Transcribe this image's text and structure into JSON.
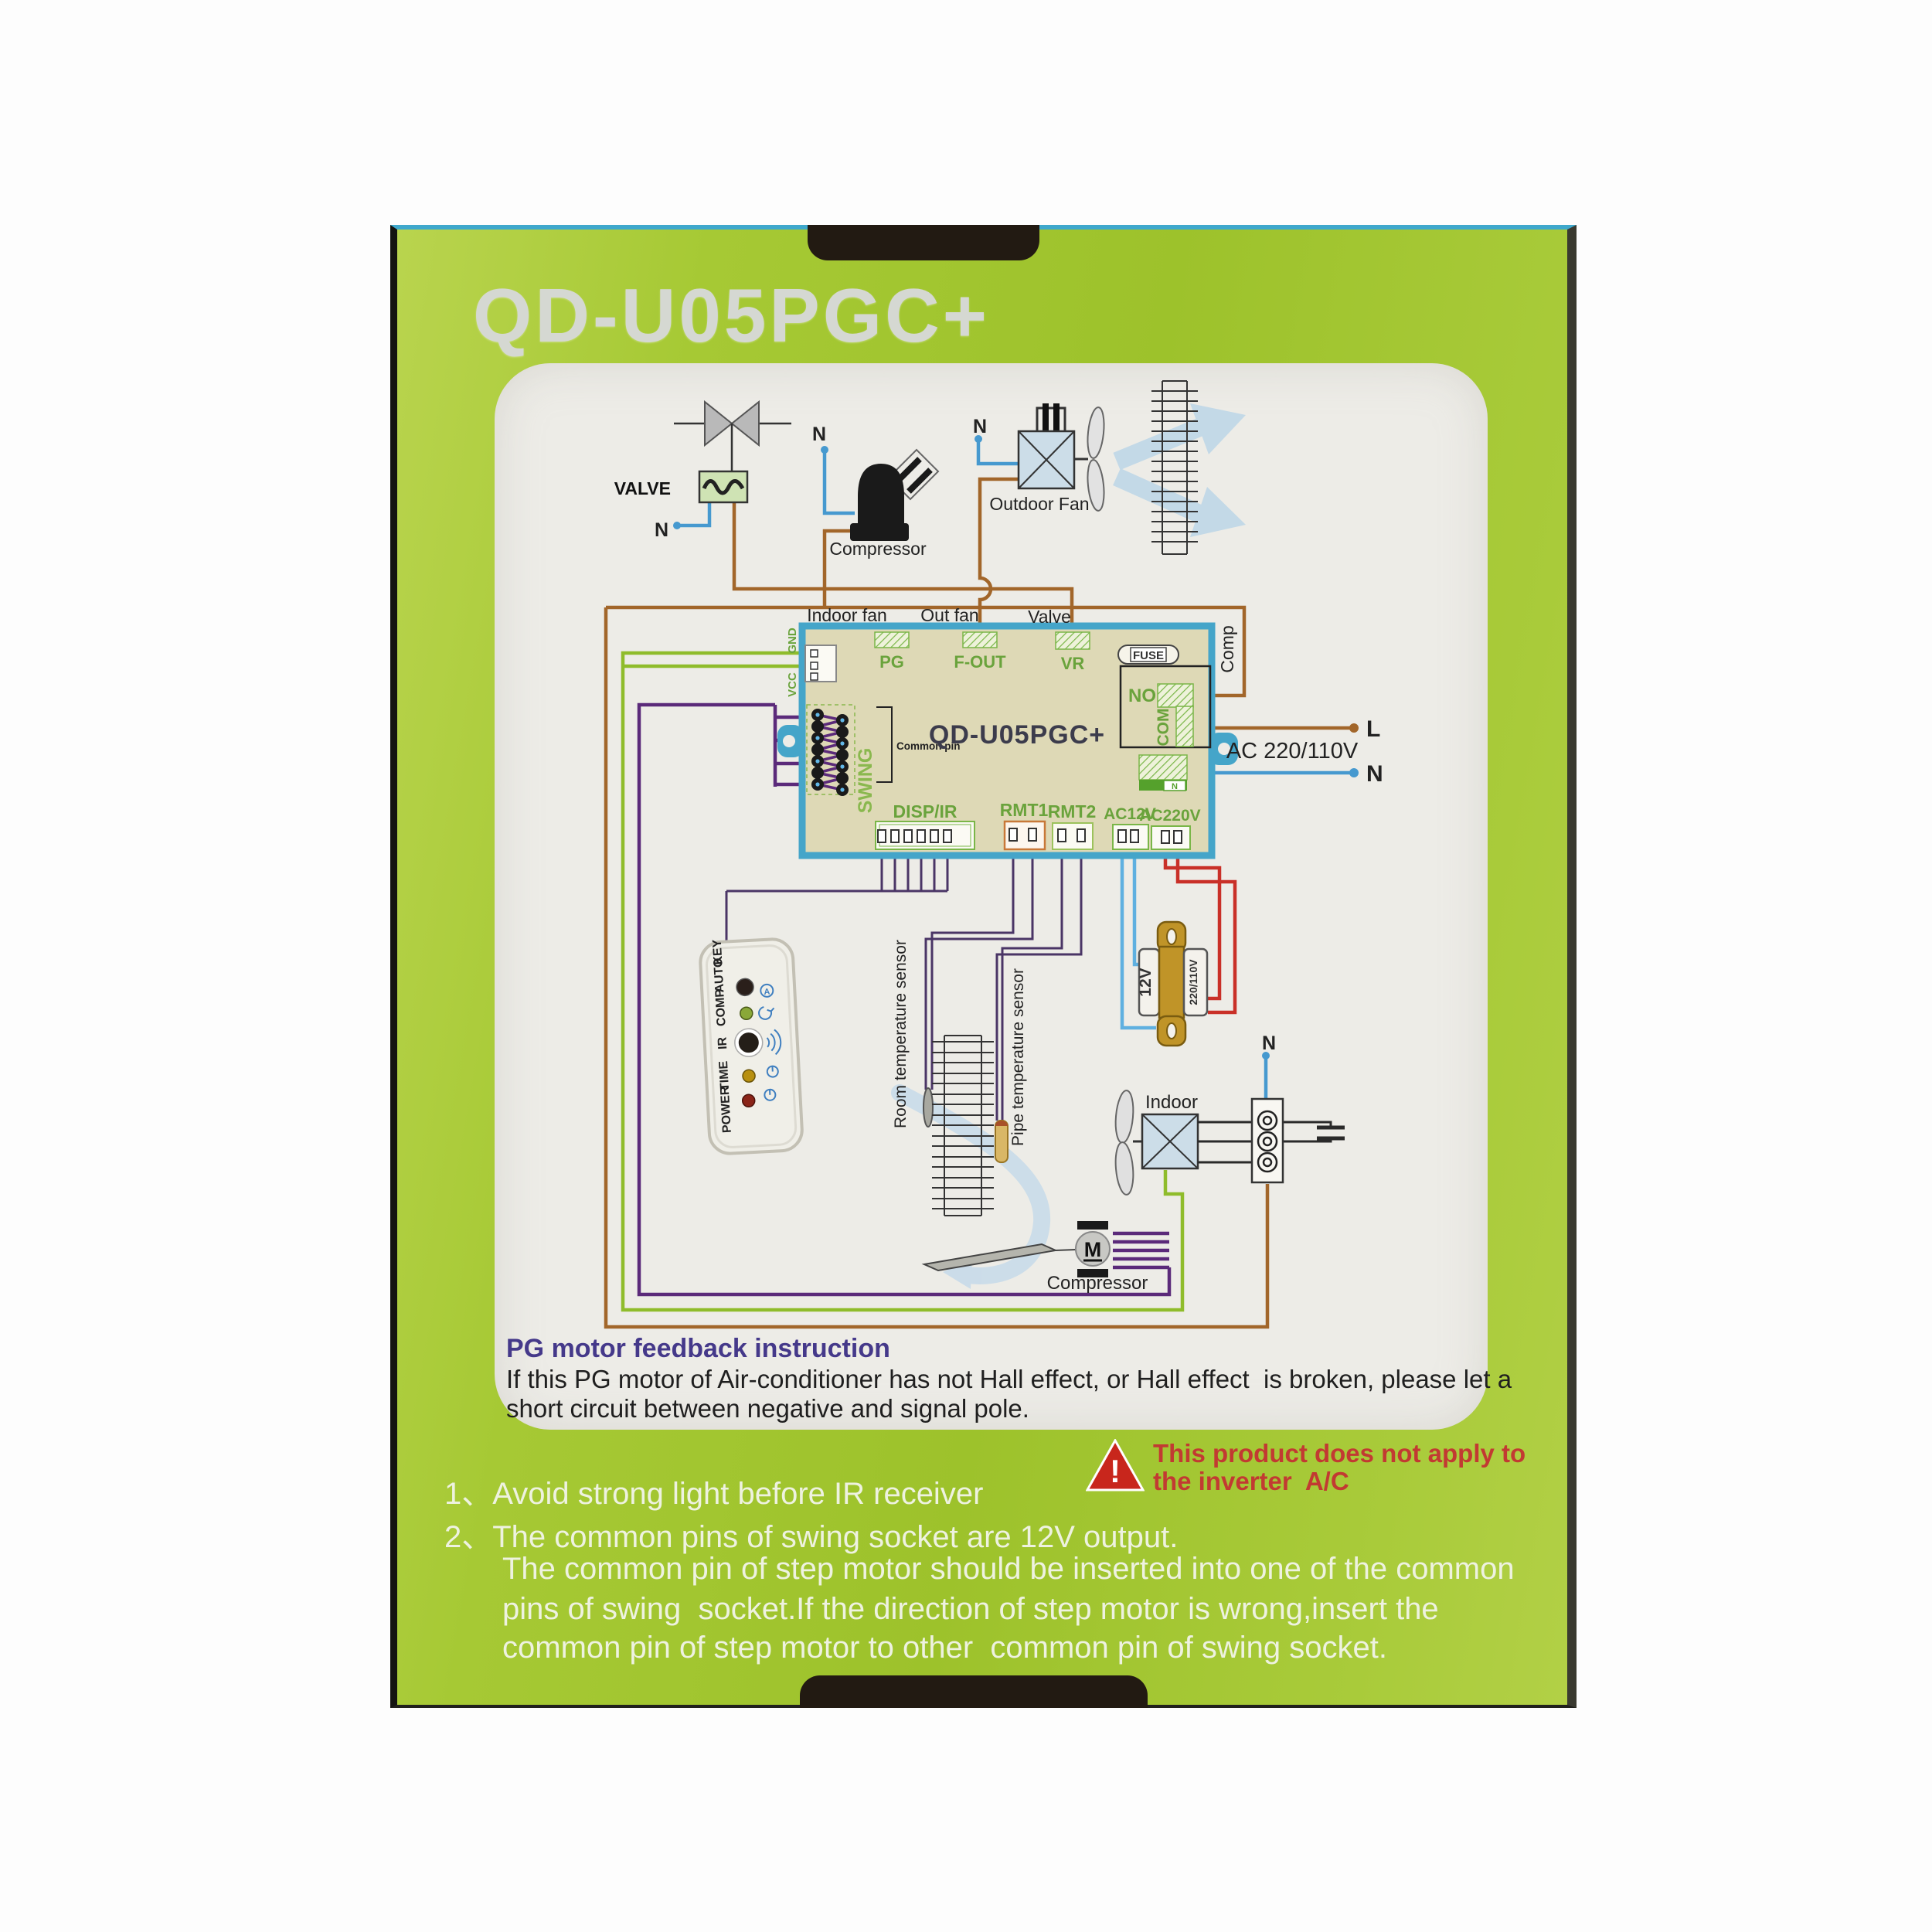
{
  "title": "QD-U05PGC+",
  "colors": {
    "box_green": "#a6c934",
    "panel": "#edece7",
    "board_fill": "#ded9b6",
    "board_border": "#45a5c9",
    "wire_brown": "#a2662a",
    "wire_blue": "#4699cf",
    "wire_light_blue": "#5fb0e0",
    "wire_green": "#8fbc2b",
    "wire_purple": "#5b2a7a",
    "wire_thin_purple": "#4a3566",
    "wire_red": "#c93028",
    "connector_green": "#6aa33c",
    "transformer_gold": "#c09428",
    "warning_red": "#c23a32",
    "heading_purple": "#45398a",
    "title_gray": "#d5d8d2"
  },
  "outdoor": {
    "valve_label": "VALVE",
    "valve_n": "N",
    "compressor_label": "Compressor",
    "compressor_n": "N",
    "fan_label": "Outdoor Fan",
    "fan_n": "N"
  },
  "board": {
    "name": "QD-U05PGC+",
    "indoor_fan": "Indoor fan",
    "out_fan": "Out fan",
    "valve": "Valve",
    "comp": "Comp",
    "pg": "PG",
    "f_out": "F-OUT",
    "vr": "VR",
    "fuse": "FUSE",
    "no": "NO",
    "com": "COM",
    "gnd": "GND",
    "vcc": "VCC",
    "swing": "SWING",
    "common_pin": "Common pin",
    "disp_ir": "DISP/IR",
    "rmt1": "RMT1",
    "rmt2": "RMT2",
    "ac12v": "AC12V",
    "ac220v": "AC220V",
    "n_chip": "N"
  },
  "power": {
    "line": "L",
    "neutral": "N",
    "ac": "AC 220/110V"
  },
  "transformer": {
    "secondary": "12V",
    "primary": "220/110V"
  },
  "display": {
    "labels": [
      "POWER",
      "TIME",
      "IR",
      "COMP",
      "AUTO",
      "KEY"
    ],
    "auto_icon": "A"
  },
  "sensors": {
    "room": "Room temperature sensor",
    "pipe": "Pipe temperature sensor"
  },
  "indoor": {
    "label": "Indoor",
    "neutral": "N",
    "motor": "M",
    "compressor": "Compressor"
  },
  "instruction": {
    "heading": "PG motor feedback instruction",
    "line1": "If this PG motor of Air-conditioner has not Hall effect, or Hall effect  is broken, please let a",
    "line2": "short circuit between negative and signal pole."
  },
  "warning": {
    "mark": "!",
    "line1": "This product does not apply to",
    "line2": "the inverter  A/C"
  },
  "notes": {
    "n1_num": "1、",
    "n1": "Avoid strong light before IR receiver",
    "n2_num": "2、",
    "n2": "The common pins of swing socket are 12V output.",
    "n2b": "The common pin of step motor should be inserted into one of the common",
    "n2c": "pins of swing  socket.If the direction of step motor is wrong,insert the",
    "n2d": "common pin of step motor to other  common pin of swing socket."
  }
}
